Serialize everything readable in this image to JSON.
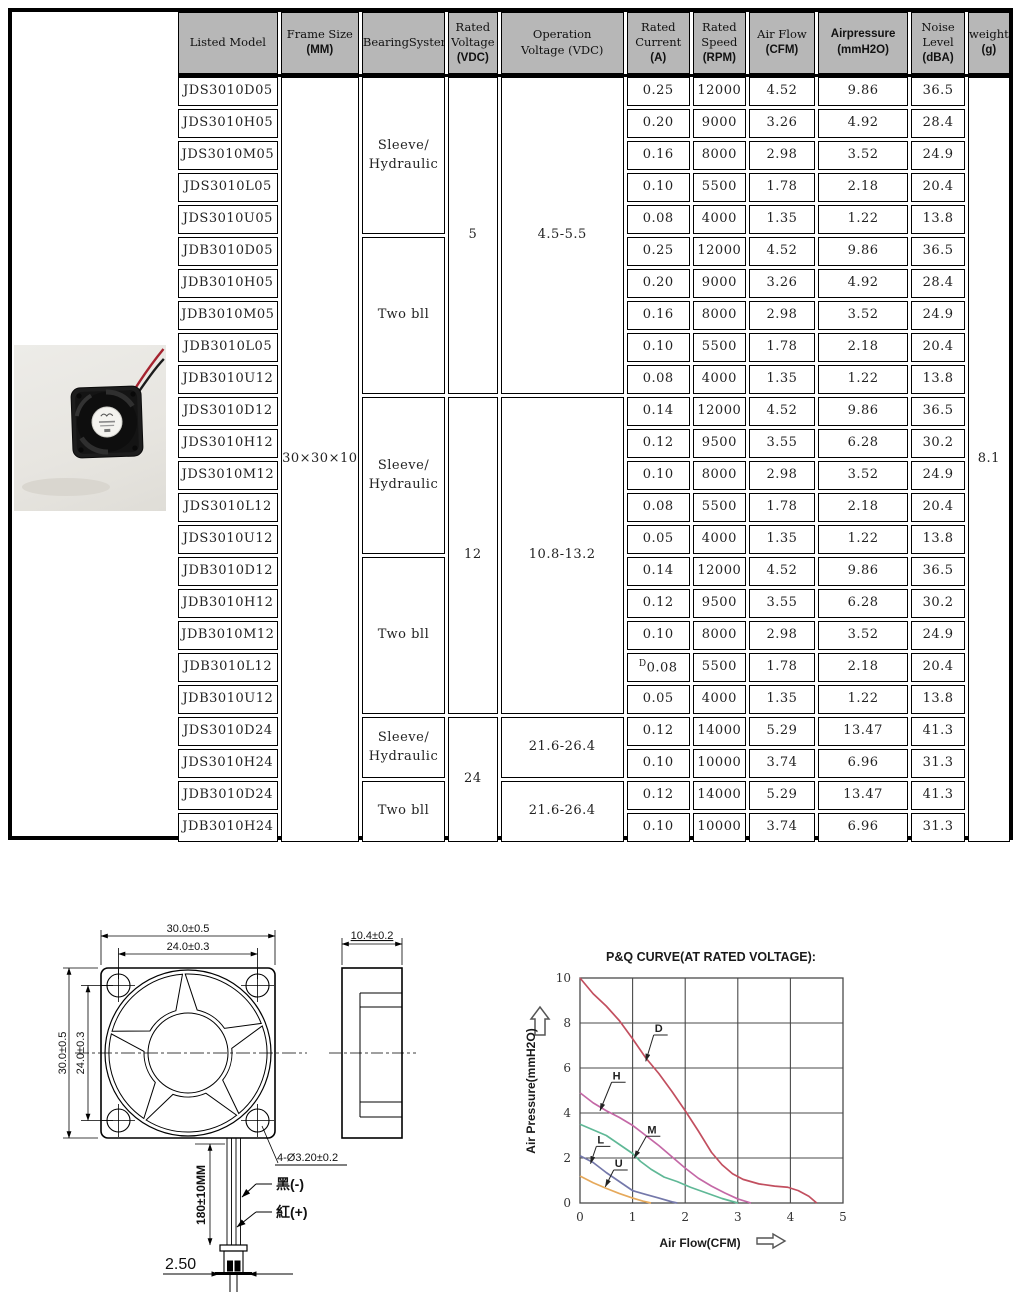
{
  "spec_table": {
    "header_bg": "#b7b7b7",
    "columns": [
      {
        "id": "model",
        "lines": [
          "Listed Model"
        ]
      },
      {
        "id": "frame",
        "lines": [
          "Frame Size",
          "(MM)"
        ]
      },
      {
        "id": "bearing",
        "lines": [
          "BearingSystem"
        ]
      },
      {
        "id": "rated_voltage",
        "lines": [
          "Rated",
          "Voltage",
          "(VDC)"
        ]
      },
      {
        "id": "operation_voltage",
        "lines": [
          "Operation",
          "Voltage (VDC)"
        ]
      },
      {
        "id": "current",
        "lines": [
          "Rated",
          "Current",
          "(A)"
        ]
      },
      {
        "id": "speed",
        "lines": [
          "Rated",
          "Speed",
          "(RPM)"
        ]
      },
      {
        "id": "airflow",
        "lines": [
          "Air Flow",
          "(CFM)"
        ]
      },
      {
        "id": "pressure",
        "lines": [
          "Airpressure",
          "(mmH2O)"
        ]
      },
      {
        "id": "noise",
        "lines": [
          "Noise",
          "Level",
          "(dBA)"
        ]
      },
      {
        "id": "weight",
        "lines": [
          "weight",
          "(g)"
        ]
      }
    ],
    "rows": [
      {
        "model": "JDS3010D05",
        "current": "0.25",
        "speed": "12000",
        "airflow": "4.52",
        "pressure": "9.86",
        "noise": "36.5"
      },
      {
        "model": "JDS3010H05",
        "current": "0.20",
        "speed": "9000",
        "airflow": "3.26",
        "pressure": "4.92",
        "noise": "28.4"
      },
      {
        "model": "JDS3010M05",
        "current": "0.16",
        "speed": "8000",
        "airflow": "2.98",
        "pressure": "3.52",
        "noise": "24.9"
      },
      {
        "model": "JDS3010L05",
        "current": "0.10",
        "speed": "5500",
        "airflow": "1.78",
        "pressure": "2.18",
        "noise": "20.4"
      },
      {
        "model": "JDS3010U05",
        "current": "0.08",
        "speed": "4000",
        "airflow": "1.35",
        "pressure": "1.22",
        "noise": "13.8"
      },
      {
        "model": "JDB3010D05",
        "current": "0.25",
        "speed": "12000",
        "airflow": "4.52",
        "pressure": "9.86",
        "noise": "36.5"
      },
      {
        "model": "JDB3010H05",
        "current": "0.20",
        "speed": "9000",
        "airflow": "3.26",
        "pressure": "4.92",
        "noise": "28.4"
      },
      {
        "model": "JDB3010M05",
        "current": "0.16",
        "speed": "8000",
        "airflow": "2.98",
        "pressure": "3.52",
        "noise": "24.9"
      },
      {
        "model": "JDB3010L05",
        "current": "0.10",
        "speed": "5500",
        "airflow": "1.78",
        "pressure": "2.18",
        "noise": "20.4"
      },
      {
        "model": "JDB3010U12",
        "current": "0.08",
        "speed": "4000",
        "airflow": "1.35",
        "pressure": "1.22",
        "noise": "13.8"
      },
      {
        "model": "JDS3010D12",
        "current": "0.14",
        "speed": "12000",
        "airflow": "4.52",
        "pressure": "9.86",
        "noise": "36.5"
      },
      {
        "model": "JDS3010H12",
        "current": "0.12",
        "speed": "9500",
        "airflow": "3.55",
        "pressure": "6.28",
        "noise": "30.2"
      },
      {
        "model": "JDS3010M12",
        "current": "0.10",
        "speed": "8000",
        "airflow": "2.98",
        "pressure": "3.52",
        "noise": "24.9"
      },
      {
        "model": "JDS3010L12",
        "current": "0.08",
        "speed": "5500",
        "airflow": "1.78",
        "pressure": "2.18",
        "noise": "20.4"
      },
      {
        "model": "JDS3010U12",
        "current": "0.05",
        "speed": "4000",
        "airflow": "1.35",
        "pressure": "1.22",
        "noise": "13.8"
      },
      {
        "model": "JDB3010D12",
        "current": "0.14",
        "speed": "12000",
        "airflow": "4.52",
        "pressure": "9.86",
        "noise": "36.5"
      },
      {
        "model": "JDB3010H12",
        "current": "0.12",
        "speed": "9500",
        "airflow": "3.55",
        "pressure": "6.28",
        "noise": "30.2"
      },
      {
        "model": "JDB3010M12",
        "current": "0.10",
        "speed": "8000",
        "airflow": "2.98",
        "pressure": "3.52",
        "noise": "24.9"
      },
      {
        "model": "JDB3010L12",
        "current": "0.08",
        "current_prefix": "D",
        "speed": "5500",
        "airflow": "1.78",
        "pressure": "2.18",
        "noise": "20.4"
      },
      {
        "model": "JDB3010U12",
        "current": "0.05",
        "speed": "4000",
        "airflow": "1.35",
        "pressure": "1.22",
        "noise": "13.8"
      },
      {
        "model": "JDS3010D24",
        "current": "0.12",
        "speed": "14000",
        "airflow": "5.29",
        "pressure": "13.47",
        "noise": "41.3"
      },
      {
        "model": "JDS3010H24",
        "current": "0.10",
        "speed": "10000",
        "airflow": "3.74",
        "pressure": "6.96",
        "noise": "31.3"
      },
      {
        "model": "JDB3010D24",
        "current": "0.12",
        "speed": "14000",
        "airflow": "5.29",
        "pressure": "13.47",
        "noise": "41.3"
      },
      {
        "model": "JDB3010H24",
        "current": "0.10",
        "speed": "10000",
        "airflow": "3.74",
        "pressure": "6.96",
        "noise": "31.3"
      }
    ],
    "merges": {
      "frame": [
        {
          "row": 0,
          "span": 24,
          "lines": [
            "30×30×10"
          ]
        }
      ],
      "bearing": [
        {
          "row": 0,
          "span": 5,
          "lines": [
            "Sleeve/",
            "Hydraulic"
          ]
        },
        {
          "row": 5,
          "span": 5,
          "lines": [
            "Two bll"
          ]
        },
        {
          "row": 10,
          "span": 5,
          "lines": [
            "Sleeve/",
            "Hydraulic"
          ]
        },
        {
          "row": 15,
          "span": 5,
          "lines": [
            "Two bll"
          ]
        },
        {
          "row": 20,
          "span": 2,
          "lines": [
            "Sleeve/",
            "Hydraulic"
          ]
        },
        {
          "row": 22,
          "span": 2,
          "lines": [
            "Two bll"
          ]
        }
      ],
      "rated_voltage": [
        {
          "row": 0,
          "span": 10,
          "lines": [
            "5"
          ]
        },
        {
          "row": 10,
          "span": 10,
          "lines": [
            "12"
          ]
        },
        {
          "row": 20,
          "span": 4,
          "lines": [
            "24"
          ]
        }
      ],
      "operation_voltage": [
        {
          "row": 0,
          "span": 10,
          "lines": [
            "4.5-5.5"
          ]
        },
        {
          "row": 10,
          "span": 10,
          "lines": [
            "10.8-13.2"
          ]
        },
        {
          "row": 20,
          "span": 2,
          "lines": [
            "21.6-26.4"
          ]
        },
        {
          "row": 22,
          "span": 2,
          "lines": [
            "21.6-26.4"
          ]
        }
      ],
      "weight": [
        {
          "row": 0,
          "span": 24,
          "lines": [
            "8.1"
          ]
        }
      ]
    }
  },
  "photo": {
    "wire_red": "#a5232f",
    "wire_black": "#1c1c1c"
  },
  "drawing": {
    "dim_width": "30.0±0.5",
    "dim_hole_spacing_h": "24.0±0.3",
    "dim_height": "30.0±0.5",
    "dim_hole_spacing_v": "24.0±0.3",
    "dim_depth": "10.4±0.2",
    "hole_callout": "4-Ø3.20±0.2",
    "wire_black_label": "黑(-)",
    "wire_red_label": "紅(+)",
    "wire_length": "180±10MM",
    "connector_pitch": "2.50"
  },
  "chart_data": {
    "type": "line",
    "title": "P&Q CURVE(AT RATED VOLTAGE):",
    "xlabel": "Air Flow(CFM)",
    "ylabel": "Air Pressure(mmH2O)",
    "xlim": [
      0,
      5
    ],
    "ylim": [
      0,
      10
    ],
    "xticks": [
      0,
      1,
      2,
      3,
      4,
      5
    ],
    "yticks": [
      0,
      2,
      4,
      6,
      8,
      10
    ],
    "grid": true,
    "legend_position": "inline-labels",
    "grid_color": "#4a4a4a",
    "series": [
      {
        "name": "D",
        "color": "#c24f5f",
        "points": [
          [
            0,
            10
          ],
          [
            0.25,
            9.3
          ],
          [
            0.5,
            8.75
          ],
          [
            0.75,
            8.1
          ],
          [
            1.0,
            7.3
          ],
          [
            1.25,
            6.45
          ],
          [
            1.5,
            5.75
          ],
          [
            1.75,
            4.95
          ],
          [
            2.0,
            4.1
          ],
          [
            2.25,
            3.2
          ],
          [
            2.5,
            2.25
          ],
          [
            2.7,
            1.7
          ],
          [
            2.9,
            1.3
          ],
          [
            3.1,
            1.05
          ],
          [
            3.4,
            0.85
          ],
          [
            3.7,
            0.75
          ],
          [
            3.95,
            0.7
          ],
          [
            4.15,
            0.55
          ],
          [
            4.35,
            0.3
          ],
          [
            4.5,
            0
          ]
        ]
      },
      {
        "name": "H",
        "color": "#c468a6",
        "points": [
          [
            0,
            4.9
          ],
          [
            0.25,
            4.45
          ],
          [
            0.5,
            4.1
          ],
          [
            0.75,
            3.8
          ],
          [
            1.0,
            3.45
          ],
          [
            1.25,
            3.0
          ],
          [
            1.5,
            2.55
          ],
          [
            1.75,
            2.05
          ],
          [
            2.0,
            1.55
          ],
          [
            2.25,
            1.1
          ],
          [
            2.5,
            0.75
          ],
          [
            2.75,
            0.45
          ],
          [
            3.0,
            0.18
          ],
          [
            3.25,
            0
          ]
        ]
      },
      {
        "name": "M",
        "color": "#5fb896",
        "points": [
          [
            0,
            3.5
          ],
          [
            0.25,
            3.25
          ],
          [
            0.5,
            3.0
          ],
          [
            0.75,
            2.6
          ],
          [
            1.0,
            2.2
          ],
          [
            1.15,
            1.85
          ],
          [
            1.35,
            1.5
          ],
          [
            1.6,
            1.15
          ],
          [
            1.85,
            0.95
          ],
          [
            2.1,
            0.7
          ],
          [
            2.4,
            0.45
          ],
          [
            2.7,
            0.2
          ],
          [
            3.0,
            0
          ]
        ]
      },
      {
        "name": "L",
        "color": "#7478aa",
        "points": [
          [
            0,
            2.1
          ],
          [
            0.25,
            1.8
          ],
          [
            0.5,
            1.35
          ],
          [
            0.75,
            0.95
          ],
          [
            1.0,
            0.55
          ],
          [
            1.25,
            0.38
          ],
          [
            1.5,
            0.22
          ],
          [
            1.75,
            0.05
          ],
          [
            1.85,
            0
          ]
        ]
      },
      {
        "name": "U",
        "color": "#e6a95b",
        "points": [
          [
            0,
            1.2
          ],
          [
            0.25,
            0.9
          ],
          [
            0.5,
            0.65
          ],
          [
            0.75,
            0.42
          ],
          [
            1.0,
            0.22
          ],
          [
            1.2,
            0.08
          ],
          [
            1.35,
            0
          ]
        ]
      }
    ],
    "labels": [
      {
        "text": "D",
        "x": 1.42,
        "y": 7.6,
        "tx": 1.25,
        "ty": 6.3
      },
      {
        "text": "H",
        "x": 0.62,
        "y": 5.5,
        "tx": 0.38,
        "ty": 4.1
      },
      {
        "text": "M",
        "x": 1.28,
        "y": 3.1,
        "tx": 1.03,
        "ty": 2.0
      },
      {
        "text": "L",
        "x": 0.33,
        "y": 2.65,
        "tx": 0.2,
        "ty": 1.75
      },
      {
        "text": "U",
        "x": 0.66,
        "y": 1.6,
        "tx": 0.48,
        "ty": 0.72
      }
    ]
  }
}
